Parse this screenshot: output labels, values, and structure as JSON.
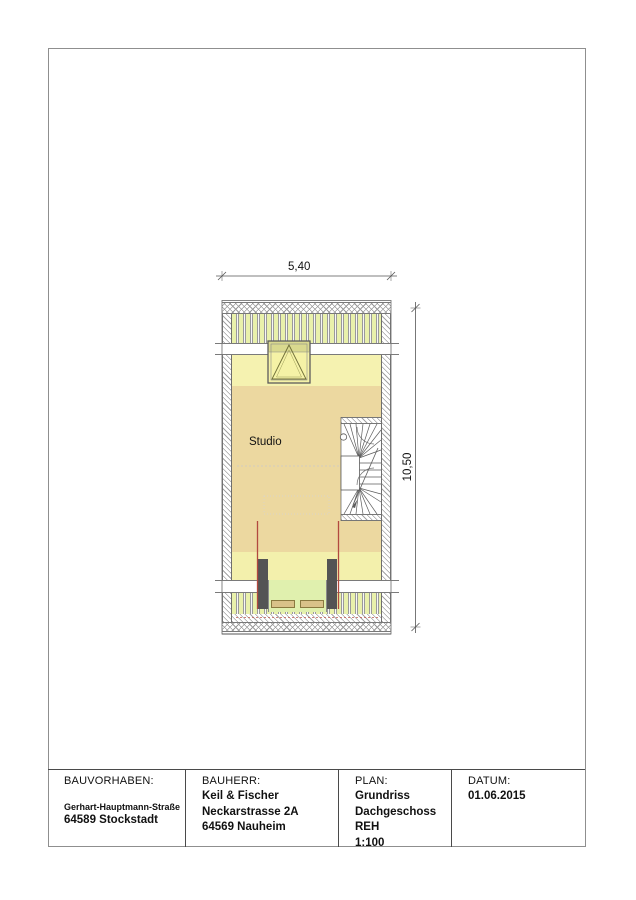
{
  "plan": {
    "room_label": "Studio",
    "width_dim": "5,40",
    "height_dim": "10,50"
  },
  "title_block": {
    "project": {
      "label": "BAUVORHABEN:",
      "line1": "Gerhart-Hauptmann-Straße",
      "line2": "64589 Stockstadt"
    },
    "client": {
      "label": "BAUHERR:",
      "line1": "Keil & Fischer",
      "line2": "Neckarstrasse 2A",
      "line3": "64569 Nauheim"
    },
    "plan_info": {
      "label": "PLAN:",
      "line1": "Grundriss",
      "line2": "Dachgeschoss",
      "line3": "REH",
      "line4": "1:100"
    },
    "date": {
      "label": "DATUM:",
      "value": "01.06.2015"
    }
  },
  "colors": {
    "floor_tan": "#ecd8a0",
    "floor_light": "#f5f2b0",
    "roof_band_green": "#e9f1ab",
    "balcony_green": "#e0f0ae",
    "marker_red": "#b2493f",
    "pillar_gray": "#545454"
  }
}
